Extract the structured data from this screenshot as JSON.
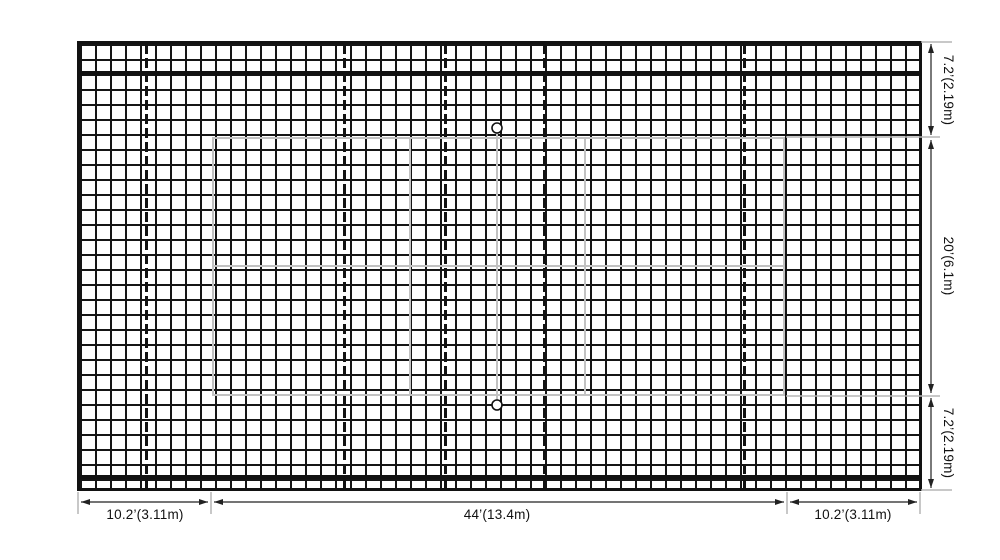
{
  "diagram": {
    "type": "net-with-badminton-court-dimension-drawing",
    "dimensions": {
      "right": [
        {
          "id": "top-margin",
          "label": "7.2’(2.19m)"
        },
        {
          "id": "court-width",
          "label": "20’(6.1m)"
        },
        {
          "id": "bottom-margin",
          "label": "7.2’(2.19m)"
        }
      ],
      "bottom": [
        {
          "id": "left-margin",
          "label": "10.2’(3.11m)"
        },
        {
          "id": "court-length",
          "label": "44’(13.4m)"
        },
        {
          "id": "right-margin",
          "label": "10.2’(3.11m)"
        }
      ]
    },
    "colors": {
      "mesh": "#121212",
      "court_line": "#c2c2c2",
      "dimension_line": "#222222",
      "extension_line": "#b5b5b5"
    }
  }
}
